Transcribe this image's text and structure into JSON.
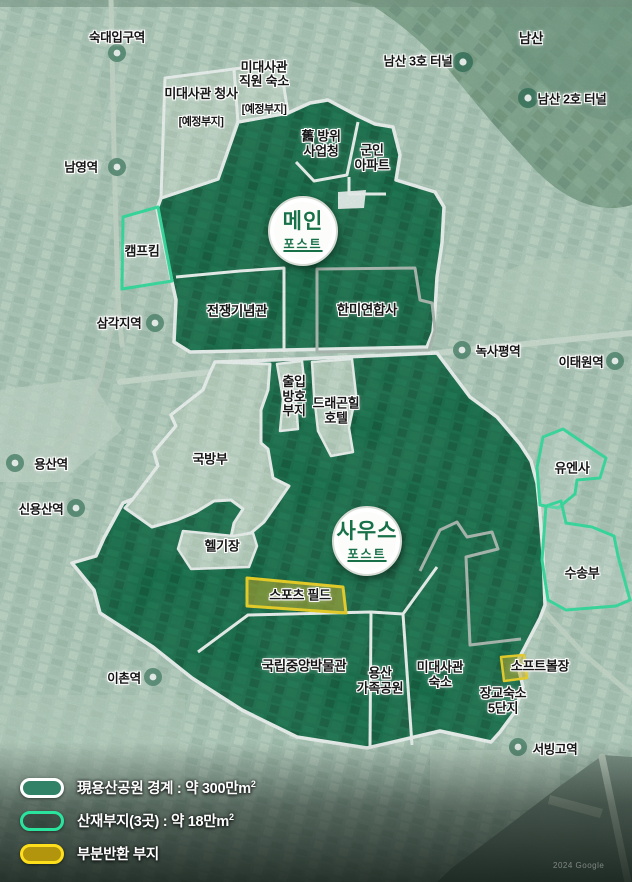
{
  "posts": [
    {
      "id": "main",
      "title": "메인",
      "subtitle": "포스트"
    },
    {
      "id": "south",
      "title": "사우스",
      "subtitle": "포스트"
    }
  ],
  "areas": {
    "embassy_office": {
      "name": "미대사관 청사",
      "note": "[예정부지]"
    },
    "embassy_staff": {
      "name": "미대사관\n직원 숙소",
      "note": "[예정부지]"
    },
    "old_dapa": {
      "name": "舊 방위\n사업청"
    },
    "military_apartment": {
      "name": "군인\n아파트"
    },
    "camp_kim": {
      "name": "캠프킴"
    },
    "war_memorial": {
      "name": "전쟁기념관"
    },
    "cfc": {
      "name": "한미연합사"
    },
    "access_control": {
      "name": "출입\n방호\n부지"
    },
    "dragon_hill": {
      "name": "드래곤힐\n호텔"
    },
    "mnd": {
      "name": "국방부"
    },
    "heliport": {
      "name": "헬기장"
    },
    "unc": {
      "name": "유엔사"
    },
    "transport_unit": {
      "name": "수송부"
    },
    "sports_field": {
      "name": "스포츠 필드"
    },
    "museum": {
      "name": "국립중앙박물관"
    },
    "family_park": {
      "name": "용산\n가족공원"
    },
    "embassy_housing": {
      "name": "미대사관\n숙소"
    },
    "softball": {
      "name": "소프트볼장"
    },
    "officer_housing": {
      "name": "장교숙소\n5단지"
    }
  },
  "stations": [
    {
      "id": "sookdae",
      "name": "숙대입구역"
    },
    {
      "id": "namyeong",
      "name": "남영역"
    },
    {
      "id": "samgakji",
      "name": "삼각지역"
    },
    {
      "id": "yongsan",
      "name": "용산역"
    },
    {
      "id": "sinyongsan",
      "name": "신용산역"
    },
    {
      "id": "ichon",
      "name": "이촌역"
    },
    {
      "id": "noksapyeong",
      "name": "녹사평역"
    },
    {
      "id": "itaewon",
      "name": "이태원역"
    },
    {
      "id": "seobinggo",
      "name": "서빙고역"
    }
  ],
  "landmarks": [
    {
      "id": "namsan",
      "name": "남산"
    },
    {
      "id": "tunnel3",
      "name": "남산 3호 터널"
    },
    {
      "id": "tunnel2",
      "name": "남산 2호 터널"
    }
  ],
  "legend": {
    "items": [
      {
        "id": "park-boundary",
        "label": "現용산공원 경계 : 약 300만m",
        "sup": "2",
        "swatch_fill": "#318266",
        "swatch_border": "#ffffff"
      },
      {
        "id": "scattered-sites",
        "label": "산재부지(3곳) : 약 18만m",
        "sup": "2",
        "swatch_fill": "rgba(22,42,33,0.38)",
        "swatch_border": "#2ae49e"
      },
      {
        "id": "partial-return",
        "label": "부분반환 부지",
        "sup": "",
        "swatch_fill": "#b3940d",
        "swatch_border": "#ffdf1c"
      }
    ]
  },
  "colors": {
    "park_green": "#0e6843",
    "background": "#b7cec0",
    "forest": "#7da189",
    "boundary_white": "#ffffff",
    "boundary_gray": "#b4bcb6",
    "scattered_mint": "#2ee6a2",
    "partial_yellow": "#ffd916",
    "post_text_green": "#177048",
    "river": "#84958a"
  },
  "watermark": "2024 Google"
}
